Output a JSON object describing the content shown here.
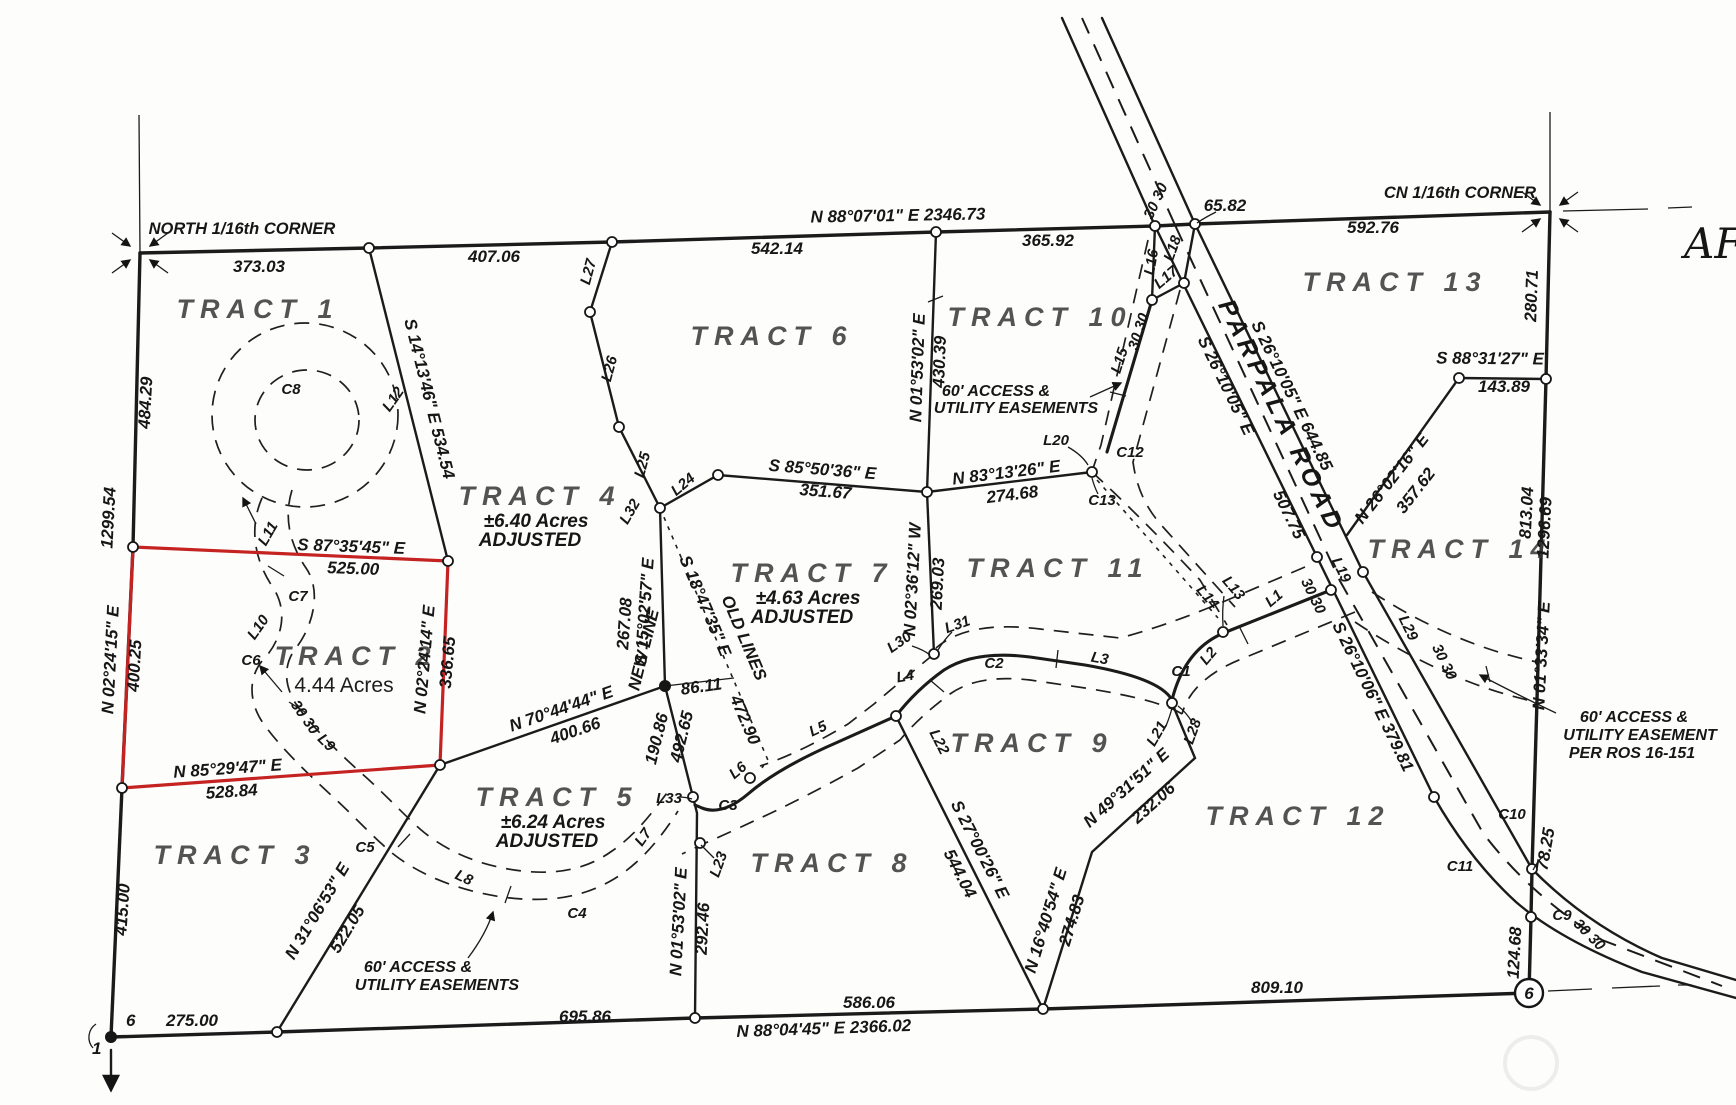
{
  "corners": {
    "north_sixteenth": "NORTH 1/16th CORNER",
    "cn_sixteenth": "CN 1/16th CORNER"
  },
  "roads": {
    "parpala": "PARPALA ROAD"
  },
  "misc": {
    "aff": "AFF"
  },
  "monuments": {
    "sec1": "1",
    "sec6": "6",
    "circle6": "6"
  },
  "notes": {
    "new_line": "NEW LINE",
    "old_lines": "OLD LINES",
    "width": "30 30"
  },
  "easements": {
    "t10_1": "60' ACCESS &",
    "t10_2": "UTILITY EASEMENTS",
    "t3_1": "60' ACCESS &",
    "t3_2": "UTILITY EASEMENTS",
    "t14_1": "60' ACCESS &",
    "t14_2": "UTILITY EASEMENT",
    "t14_3": "PER ROS 16-151"
  },
  "tracts": {
    "t1": {
      "name": "TRACT 1"
    },
    "t2": {
      "name": "TRACT 2",
      "acres": "4.44 Acres"
    },
    "t3": {
      "name": "TRACT 3"
    },
    "t4": {
      "name": "TRACT 4",
      "acres": "±6.40 Acres",
      "adjusted": "ADJUSTED"
    },
    "t5": {
      "name": "TRACT 5",
      "acres": "±6.24 Acres",
      "adjusted": "ADJUSTED"
    },
    "t6": {
      "name": "TRACT 6"
    },
    "t7": {
      "name": "TRACT 7",
      "acres": "±4.63 Acres",
      "adjusted": "ADJUSTED"
    },
    "t8": {
      "name": "TRACT 8"
    },
    "t9": {
      "name": "TRACT 9"
    },
    "t10": {
      "name": "TRACT 10"
    },
    "t11": {
      "name": "TRACT 11"
    },
    "t12": {
      "name": "TRACT 12"
    },
    "t13": {
      "name": "TRACT 13"
    },
    "t14": {
      "name": "TRACT 14"
    }
  },
  "bearings": {
    "top": "N 88°07'01\" E  2346.73",
    "bottom": "N 88°04'45\" E  2366.02",
    "s1413": "S 14°13'46\" E  534.54",
    "s8735": "S 87°35'45\" E",
    "n0224_15": "N 02°24'15\" E",
    "n0224_14": "N 02°24'14\" E",
    "n8529": "N 85°29'47\" E",
    "n3106": "N 31°06'53\" E",
    "s2700": "S 27°00'26\" E",
    "n1640": "N 16°40'54\" E",
    "n4931": "N 49°31'51\" E",
    "n0153a": "N 01°53'02\" E",
    "n0153b": "N 01°53'02\" E",
    "n7044": "N 70°44'44\" E",
    "s1502": "S 15°02'57\" E",
    "s1847": "S 18°47'35\" E",
    "s8550": "S 85°50'36\" E",
    "n8313": "N 83°13'26\" E",
    "n0236": "N 02°36'12\" W",
    "s2610a": "S 26°10'05\" E  644.85",
    "s2610b": "S 26°10'05\" E",
    "s2610c": "S 26°10'06\" E  379.81",
    "n2602": "N 26°02'16\" E",
    "s8831": "S 88°31'27\" E",
    "n0133": "N 01°33'34\" E"
  },
  "distances": {
    "d373": "373.03",
    "d407": "407.06",
    "d542": "542.14",
    "d365": "365.92",
    "d65": "65.82",
    "d592": "592.76",
    "d484": "484.29",
    "d1299": "1299.54",
    "d400_25": "400.25",
    "d415": "415.00",
    "d525": "525.00",
    "d336": "336.65",
    "d528": "528.84",
    "d275": "275.00",
    "d695": "695.86",
    "d586": "586.06",
    "d809": "809.10",
    "d522": "522.05",
    "d544": "544.04",
    "d274_83": "274.83",
    "d232": "232.06",
    "d292": "292.46",
    "d400_66": "400.66",
    "d190": "190.86",
    "d492": "492.65",
    "d86": "86.11",
    "d267": "267.08",
    "d472": "472.90",
    "d351": "351.67",
    "d274_68": "274.68",
    "d269": "269.03",
    "d430": "430.39",
    "d507": "507.75",
    "d357": "357.62",
    "d143": "143.89",
    "d280": "280.71",
    "d813": "813.04",
    "d1296": "1296.69",
    "d78": "78.25",
    "d124": "124.68"
  },
  "lines": {
    "l1": "L1",
    "l2": "L2",
    "l3": "L3",
    "l4": "L4",
    "l5": "L5",
    "l6": "L6",
    "l7": "L7",
    "l8": "L8",
    "l9": "L9",
    "l10": "L10",
    "l11": "L11",
    "l12": "L12",
    "l13": "L13",
    "l14": "L14",
    "l15": "L15",
    "l16": "L16",
    "l17": "L17",
    "l18": "L18",
    "l19": "L19",
    "l20": "L20",
    "l21": "L21",
    "l22": "L22",
    "l23": "L23",
    "l24": "L24",
    "l25": "L25",
    "l26": "L26",
    "l27": "L27",
    "l28": "L28",
    "l29": "L29",
    "l30": "L30",
    "l31": "L31",
    "l32": "L32",
    "l33": "L33"
  },
  "curves": {
    "c1": "C1",
    "c2": "C2",
    "c3": "C3",
    "c4": "C4",
    "c5": "C5",
    "c6": "C6",
    "c7": "C7",
    "c8": "C8",
    "c9": "C9",
    "c10": "C10",
    "c11": "C11",
    "c12": "C12",
    "c13": "C13"
  }
}
